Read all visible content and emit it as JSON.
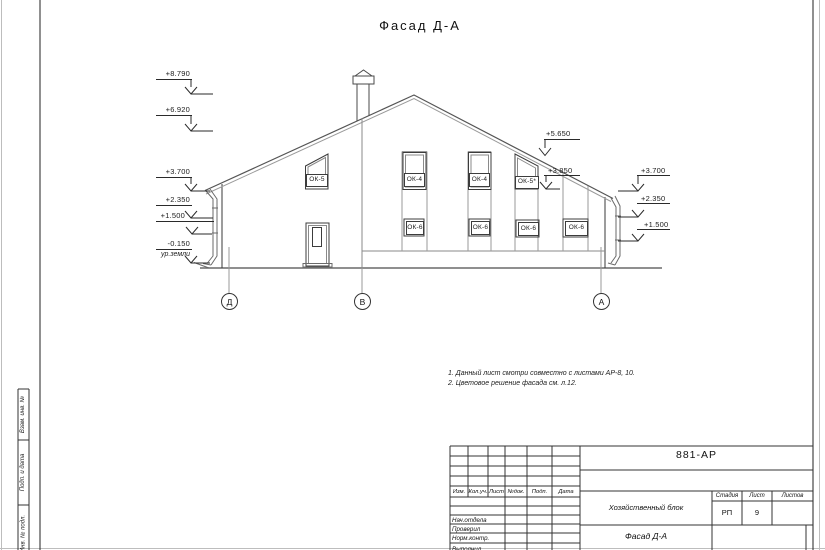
{
  "sheet": {
    "title": "Фасад Д-А"
  },
  "marks": {
    "m8790": "+8.790",
    "m6920": "+6.920",
    "m3700_left": "+3.700",
    "m2350_left": "+2.350",
    "m1500_left": "+1.500",
    "m0150": "-0.150",
    "ground": "ур.земли",
    "m5650": "+5.650",
    "m3850": "+3.850",
    "m3700_right": "+3.700",
    "m2350_right": "+2.350",
    "m1500_right": "+1.500"
  },
  "windows": {
    "ok5": "ОК-5",
    "ok4a": "ОК-4",
    "ok4b": "ОК-4",
    "ok5s": "ОК-5*",
    "ok6a": "ОК-6",
    "ok6b": "ОК-6",
    "ok6c": "ОК-6",
    "ok6d": "ОК-6"
  },
  "axes": {
    "d": "Д",
    "v": "В",
    "a": "А"
  },
  "notes": {
    "line1": "1. Данный лист смотри совместно с листами АР-8, 10.",
    "line2": "2. Цветовое решение фасада см. л.12."
  },
  "stamp": {
    "doc": "881-АР",
    "cols": {
      "izm": "Изм.",
      "kol": "Кол.уч.",
      "list": "Лист",
      "ndok": "№док.",
      "podp": "Подп.",
      "data": "Дата"
    },
    "rows": {
      "r1": "Нач.отдела",
      "r2": "Проверил",
      "r3": "Норм.контр.",
      "r4": "Выполнил"
    },
    "object": "Хозяйственный блок",
    "sheet_name": "Фасад Д-А",
    "stage_h": "Стадия",
    "list_h": "Лист",
    "listov_h": "Листов",
    "stage": "РП",
    "list": "9",
    "listov": ""
  },
  "side": {
    "s1": "Взам. инв. №",
    "s2": "Подп. и дата",
    "s3": "Инв. № подл."
  }
}
